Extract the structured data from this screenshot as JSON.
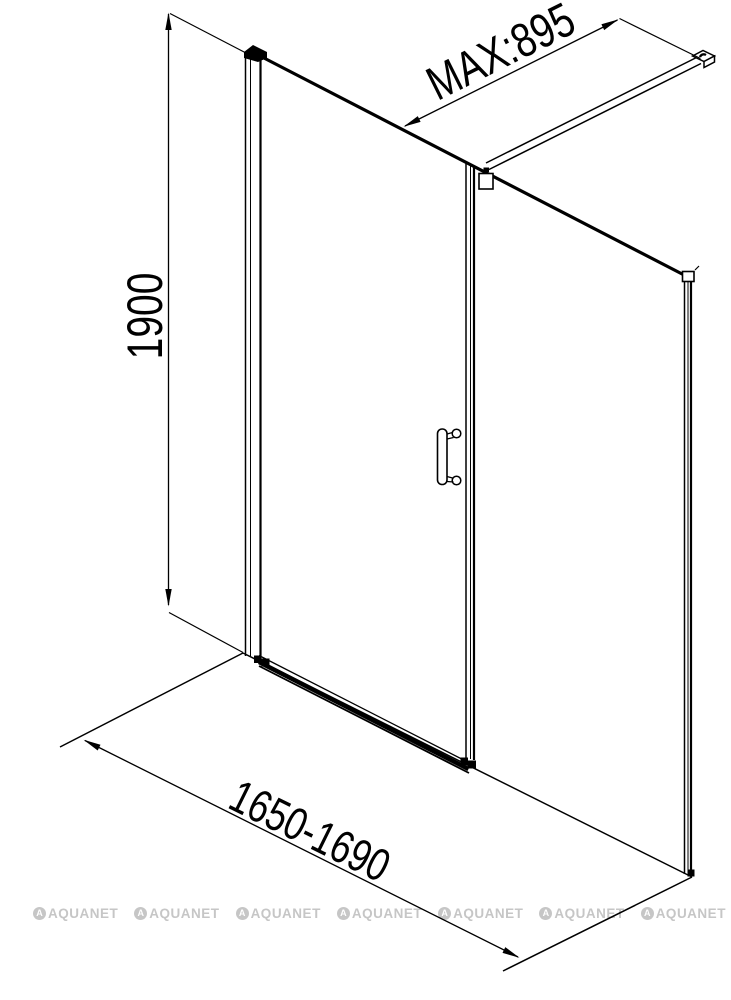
{
  "diagram": {
    "type": "technical drawing",
    "subject": "shower enclosure: hinged door with inline fixed side panel and ceiling support bar on shower tray",
    "background_color": "#ffffff",
    "line_color": "#000000",
    "dimensions": [
      {
        "id": "height",
        "label": "1900",
        "orientation": "vertical, left side"
      },
      {
        "id": "support-bar-length",
        "label": "MAX:895",
        "orientation": "diagonal depth axis, top"
      },
      {
        "id": "width-range",
        "label": "1650-1690",
        "orientation": "diagonal width axis, bottom"
      }
    ],
    "watermark": {
      "text": "AQUANET",
      "icon_letter": "A",
      "color": "#c6c6c6",
      "count": 7
    }
  }
}
